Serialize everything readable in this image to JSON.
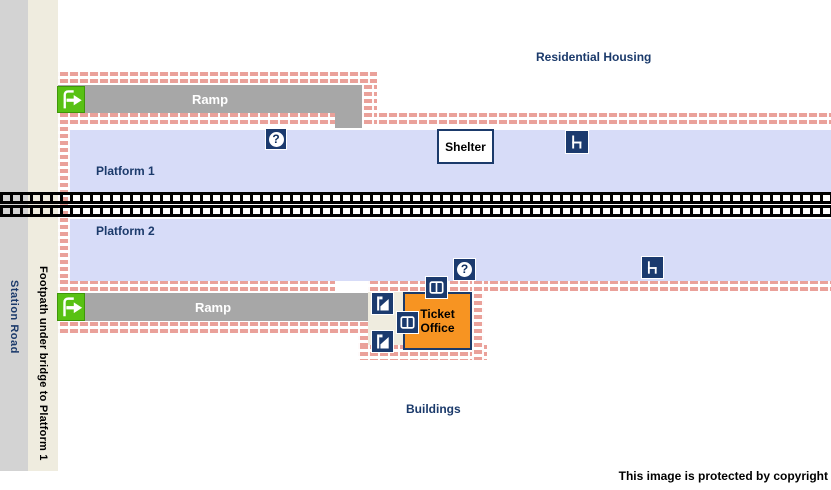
{
  "map": {
    "residential_housing": "Residential Housing",
    "buildings": "Buildings",
    "copyright": "This image is protected by copyright",
    "station_road": "Station Road",
    "footpath": "Footpath under bridge to Platform 1",
    "platform1": "Platform 1",
    "platform2": "Platform 2",
    "ramp_top": "Ramp",
    "ramp_bottom": "Ramp",
    "shelter": "Shelter",
    "ticket_office": "Ticket Office"
  },
  "icons": {
    "help_glyph": "?",
    "help": "help-point",
    "seat": "seat",
    "door": "door",
    "ticket_machine": "ticket-machine",
    "entrance": "entrance-exit"
  },
  "colors": {
    "platform_blue": "#d7dcf8",
    "brick_pink": "#eaa19a",
    "ramp_gray": "#a7a7a7",
    "icon_navy": "#1b3a6e",
    "label_navy": "#1b3a6b",
    "ticket_office_orange": "#f79422",
    "entrance_green": "#58c113",
    "road_gray": "#d3d3d3",
    "footpath_cream": "#efecdf"
  }
}
